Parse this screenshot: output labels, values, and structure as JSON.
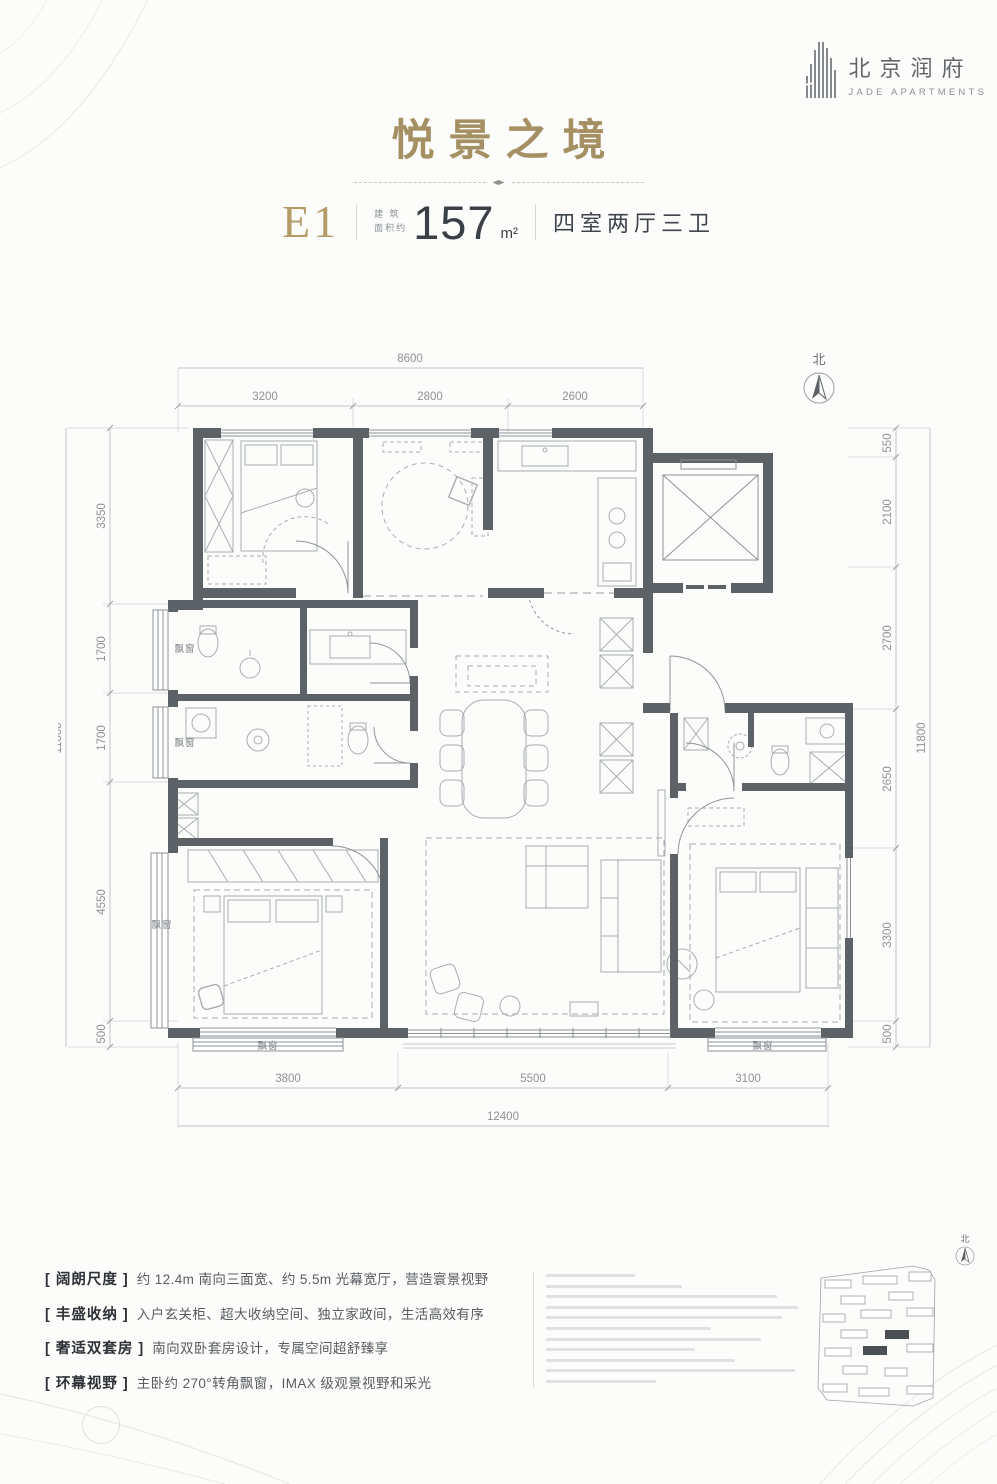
{
  "logo": {
    "cn": "北京润府",
    "en": "JADE APARTMENTS"
  },
  "title": "悦景之境",
  "unit": {
    "code": "E1",
    "area_label_l1": "建 筑",
    "area_label_l2": "面积约",
    "area_value": "157",
    "area_unit": "m²",
    "rooms": "四室两厅三卫"
  },
  "plan": {
    "north": "北",
    "bay_window": "飘窗",
    "dims": {
      "top_total": "8600",
      "top": [
        "3200",
        "2800",
        "2600"
      ],
      "left_total": "11800",
      "left": [
        "3350",
        "1700",
        "1700",
        "4550",
        "500"
      ],
      "right_total": "11800",
      "right": [
        "550",
        "2100",
        "2700",
        "2650",
        "3300",
        "500"
      ],
      "bottom_total": "12400",
      "bottom": [
        "3800",
        "5500",
        "3100"
      ]
    }
  },
  "features": [
    {
      "tag": "[ 阔朗尺度 ]",
      "desc": "约 12.4m 南向三面宽、约 5.5m 光幕宽厅，营造寰景视野"
    },
    {
      "tag": "[ 丰盛收纳 ]",
      "desc": "入户玄关柜、超大收纳空间、独立家政间，生活高效有序"
    },
    {
      "tag": "[ 奢适双套房 ]",
      "desc": "南向双卧套房设计，专属空间超舒臻享"
    },
    {
      "tag": "[ 环幕视野 ]",
      "desc": "主卧约 270°转角飘窗，IMAX 级观景视野和采光"
    }
  ],
  "disclaimer": {
    "line_widths": [
      34,
      52,
      88,
      96,
      90,
      63,
      82,
      57,
      72,
      95,
      42
    ]
  },
  "site_plan": {
    "north": "北"
  }
}
